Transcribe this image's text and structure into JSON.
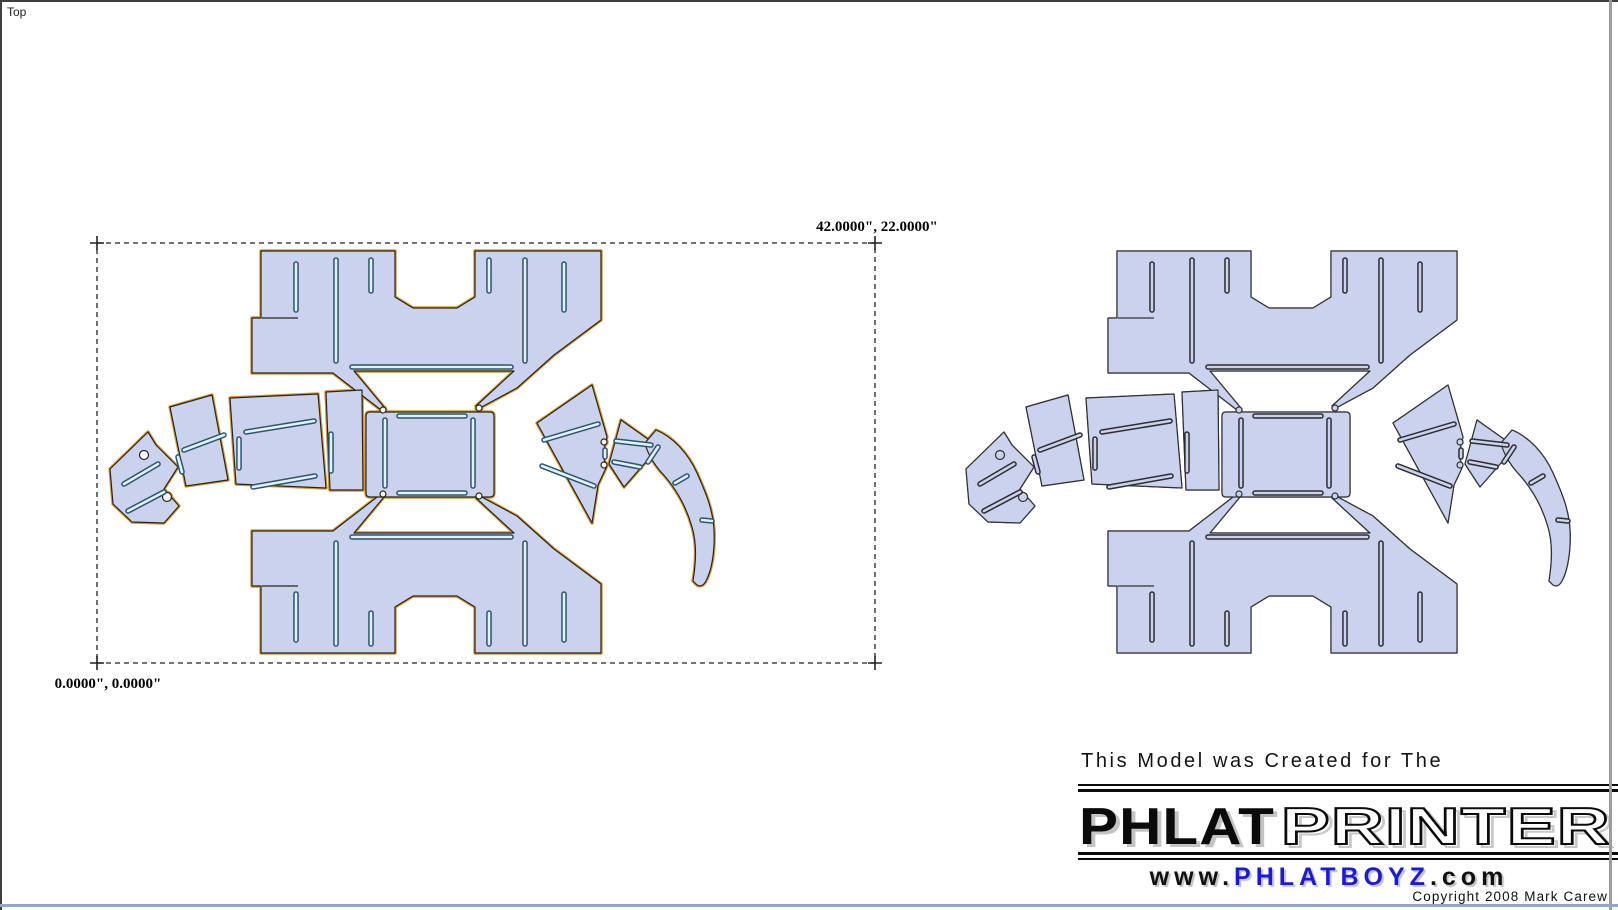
{
  "viewport": {
    "label": "Top"
  },
  "selection": {
    "extent_label": "42.0000\", 22.0000\"",
    "origin_label": "0.0000\", 0.0000\""
  },
  "branding": {
    "tagline": "This Model was Created for The",
    "logo": {
      "solid": "PHLAT",
      "outline": "PRINTER"
    },
    "website": {
      "prefix": "www.",
      "name": "PHLATBOYZ",
      "suffix": ".com"
    },
    "copyright": "Copyright 2008 Mark Carew"
  },
  "colors": {
    "piece_fill": "#cbd2ee",
    "left_outline_halo": "#d49a36",
    "left_edge": "#2b2416",
    "left_slot_stroke": "#2b556e",
    "left_slot_fill": "#e2f2fc",
    "left_hole_fill": "#f2faff",
    "right_edge": "#323232",
    "right_slot_stroke": "#2e2e2e",
    "selection_dash": "#222222",
    "rule_black": "#0a0a0a",
    "website_blue": "#1b1bd4"
  }
}
